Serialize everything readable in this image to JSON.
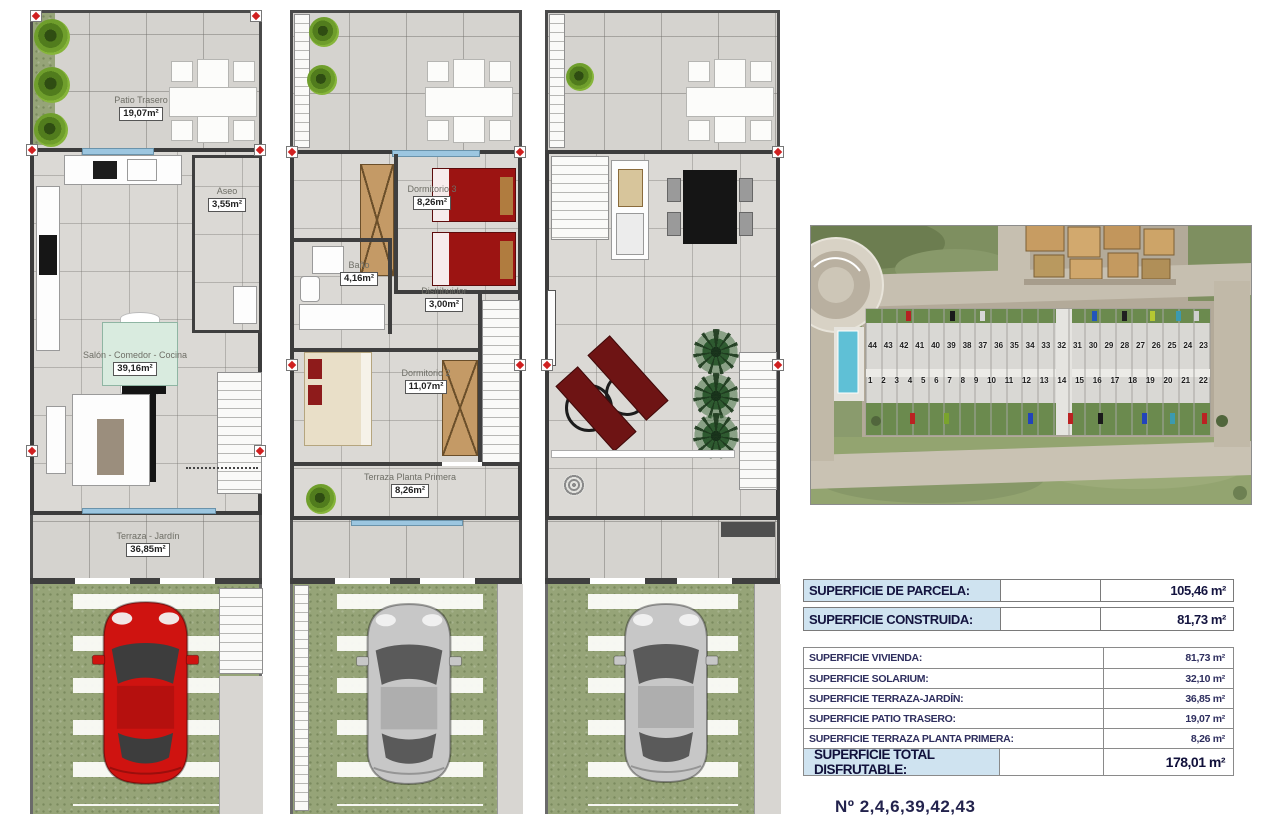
{
  "plans": {
    "ground_floor": {
      "patio_trasero": {
        "name": "Patio Trasero",
        "area": "19,07m²"
      },
      "aseo": {
        "name": "Aseo",
        "area": "3,55m²"
      },
      "salon_comedor_cocina": {
        "name": "Salón - Comedor - Cocina",
        "area": "39,16m²"
      },
      "terraza_jardin": {
        "name": "Terraza - Jardín",
        "area": "36,85m²"
      }
    },
    "first_floor": {
      "dormitorio3": {
        "name": "Dormitorio 3",
        "area": "8,26m²"
      },
      "bano": {
        "name": "Baño",
        "area": "4,16m²"
      },
      "distribuidor": {
        "name": "Distribuidor",
        "area": "3,00m²"
      },
      "dormitorio2": {
        "name": "Dormitorio 2",
        "area": "11,07m²"
      },
      "terraza_planta_primera": {
        "name": "Terraza Planta Primera",
        "area": "8,26m²"
      }
    }
  },
  "summary": {
    "parcela_label": "SUPERFICIE DE PARCELA:",
    "parcela_value": "105,46 m²",
    "construida_label": "SUPERFICIE CONSTRUIDA:",
    "construida_value": "81,73 m²",
    "details": [
      {
        "label": "SUPERFICIE VIVIENDA:",
        "value": "81,73 m²"
      },
      {
        "label": "SUPERFICIE SOLARIUM:",
        "value": "32,10 m²"
      },
      {
        "label": "SUPERFICIE TERRAZA-JARDÍN:",
        "value": "36,85 m²"
      },
      {
        "label": "SUPERFICIE PATIO TRASERO:",
        "value": "19,07 m²"
      },
      {
        "label": "SUPERFICIE TERRAZA PLANTA PRIMERA:",
        "value": "8,26 m²"
      }
    ],
    "total_label": "SUPERFICIE TOTAL DISFRUTABLE:",
    "total_value": "178,01 m²"
  },
  "aerial": {
    "house_numbers_top": [
      "44",
      "43",
      "42",
      "41",
      "40",
      "39",
      "38",
      "37",
      "36",
      "35",
      "34",
      "33",
      "32",
      "31",
      "30",
      "29",
      "28",
      "27",
      "26",
      "25",
      "24",
      "23"
    ],
    "house_numbers_bottom": [
      "1",
      "2",
      "3",
      "4",
      "5",
      "6",
      "7",
      "8",
      "9",
      "10",
      "11",
      "12",
      "13",
      "14",
      "15",
      "16",
      "17",
      "18",
      "19",
      "20",
      "21",
      "22"
    ]
  },
  "footer": {
    "plot_numbers": "Nº 2,4,6,39,42,43"
  },
  "colors": {
    "header_blue": "#cfe3f0",
    "navy_text": "#14143f",
    "red_car": "#cf1310",
    "gray_car": "#c7c7c7",
    "grass_green": "#96a478",
    "bed_red": "#9c1412"
  }
}
